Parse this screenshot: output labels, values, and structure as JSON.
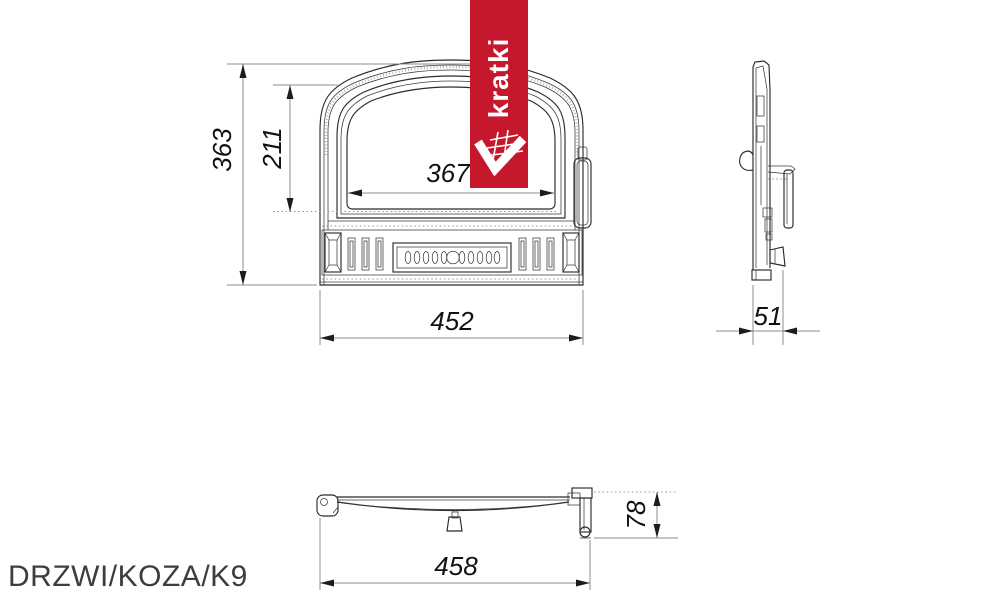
{
  "product": {
    "code": "DRZWI/KOZA/K9"
  },
  "brand": {
    "name": "kratki"
  },
  "colors": {
    "banner_red": "#c5182c",
    "line": "#2b2b2b",
    "dim_line": "#8c8c8c",
    "dim_text": "#111111"
  },
  "views": {
    "front": {
      "dims": {
        "overall_height": "363",
        "glass_height": "211",
        "glass_width": "367",
        "overall_width": "452"
      }
    },
    "side": {
      "dims": {
        "depth": "51"
      }
    },
    "bottom": {
      "dims": {
        "overall_width": "458",
        "frame_depth": "78"
      }
    }
  }
}
